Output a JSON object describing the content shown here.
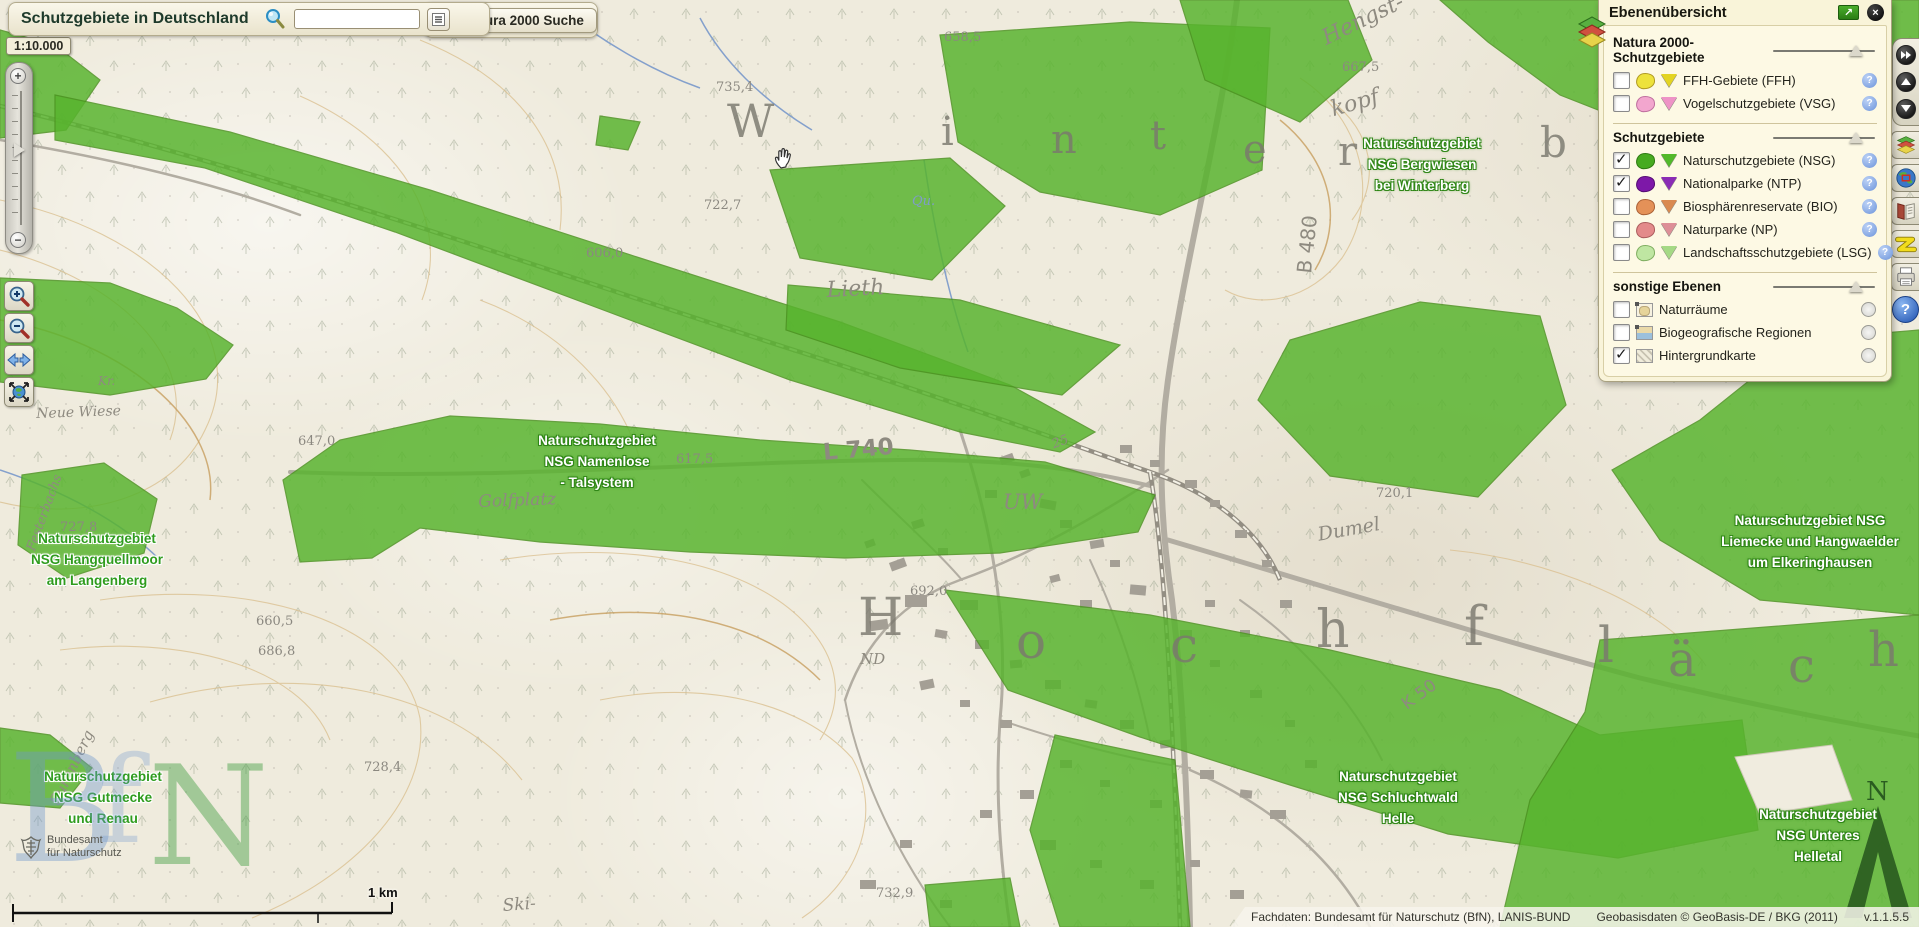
{
  "header": {
    "title": "Schutzgebiete in Deutschland",
    "search_value": "",
    "search_icon": "blue-magnifier",
    "results_icon": "list-lines",
    "natura_button": "Natura 2000 Suche",
    "natura_icon": "green-magnifier"
  },
  "scale_label": "1:10.000",
  "left_toolbar": {
    "icons": [
      "plus",
      "minus",
      "zoom-slider-thumb",
      "zoom-in-magnifier",
      "zoom-out-magnifier",
      "pan-arrows",
      "full-extent-globe"
    ]
  },
  "right_toolbar": {
    "icons": [
      "fast-forward",
      "arrow-up",
      "arrow-down",
      "layers-stack",
      "globe-overview",
      "legend-book",
      "measure-zigzag",
      "printer",
      "help"
    ],
    "help_glyph": "?"
  },
  "layer_panel": {
    "title": "Ebenenübersicht",
    "maximize_glyph": "↗",
    "close_glyph": "×",
    "sections": [
      {
        "title": "Natura 2000-Schutzgebiete",
        "items": [
          {
            "checked": false,
            "label": "FFH-Gebiete (FFH)",
            "color": "#ede23b",
            "border": "#b09a22",
            "tri": "#e3d422",
            "info": "question"
          },
          {
            "checked": false,
            "label": "Vogelschutzgebiete (VSG)",
            "color": "#f2a6ce",
            "border": "#bf6f9f",
            "tri": "#ee93c6",
            "info": "question"
          }
        ]
      },
      {
        "title": "Schutzgebiete",
        "items": [
          {
            "checked": true,
            "label": "Naturschutzgebiete (NSG)",
            "color": "#47ab21",
            "border": "#2e7a12",
            "tri": "#52b92a",
            "info": "question"
          },
          {
            "checked": true,
            "label": "Nationalparke (NTP)",
            "color": "#7d18a8",
            "border": "#550e74",
            "tri": "#8a2cb5",
            "info": "question"
          },
          {
            "checked": false,
            "label": "Biosphärenreservate (BIO)",
            "color": "#e49158",
            "border": "#aa6136",
            "tri": "#d98a50",
            "info": "question"
          },
          {
            "checked": false,
            "label": "Naturparke (NP)",
            "color": "#e38a8a",
            "border": "#ab5c5c",
            "tri": "#dd8f97",
            "info": "question"
          },
          {
            "checked": false,
            "label": "Landschaftsschutzgebiete (LSG)",
            "color": "#bfe6a2",
            "border": "#7fae60",
            "tri": "#a5d985",
            "info": "question"
          }
        ]
      },
      {
        "title": "sonstige Ebenen",
        "items": [
          {
            "checked": false,
            "label": "Naturräume",
            "icon": "naturraeume",
            "info": "radio"
          },
          {
            "checked": false,
            "label": "Biogeografische Regionen",
            "icon": "bioregionen",
            "info": "radio"
          },
          {
            "checked": true,
            "label": "Hintergrundkarte",
            "icon": "hatch",
            "info": "radio"
          }
        ]
      }
    ],
    "question_glyph": "?"
  },
  "footer": {
    "attribution": "Fachdaten: Bundesamt für Naturschutz (BfN), LANIS-BUND",
    "geodata": "Geobasisdaten © GeoBasis-DE / BKG (2011)",
    "version": "v.1.1.5.5"
  },
  "map": {
    "scalebar_label": "1 km",
    "north_label": "N",
    "bfn_logo": {
      "line1": "Bundesamt",
      "line2": "für Naturschutz"
    },
    "watermark": [
      {
        "t": "B",
        "x": 8,
        "y": 735,
        "s": 150,
        "c": "rgba(110,150,205,0.40)"
      },
      {
        "t": "f",
        "x": 98,
        "y": 742,
        "s": 120,
        "c": "rgba(110,150,205,0.30)"
      },
      {
        "t": "N",
        "x": 148,
        "y": 748,
        "s": 138,
        "c": "rgba(66,158,66,0.45)"
      }
    ],
    "area_labels_on_green": [
      {
        "x": 1422,
        "y": 133,
        "lines": [
          "Naturschutzgebiet",
          "NSG Bergwiesen",
          "bei Winterberg"
        ]
      },
      {
        "x": 597,
        "y": 430,
        "lines": [
          "Naturschutzgebiet",
          "NSG Namenlose",
          "- Talsystem"
        ]
      },
      {
        "x": 1810,
        "y": 510,
        "lines": [
          "Naturschutzgebiet NSG",
          "Liemecke und Hangwaelder",
          "um Elkeringhausen"
        ]
      },
      {
        "x": 1398,
        "y": 766,
        "lines": [
          "Naturschutzgebiet",
          "NSG Schluchtwald",
          "Helle"
        ]
      },
      {
        "x": 1818,
        "y": 804,
        "lines": [
          "Naturschutzgebiet",
          "NSG Unteres",
          "Helletal"
        ]
      }
    ],
    "area_labels_on_map": [
      {
        "x": 97,
        "y": 528,
        "lines": [
          "Naturschutzgebiet",
          "NSG Hangquellmoor",
          "am Langenberg"
        ]
      },
      {
        "x": 103,
        "y": 766,
        "lines": [
          "Naturschutzgebiet",
          "NSG Gutmecke",
          "und Renau"
        ]
      }
    ],
    "big_letters": [
      {
        "t": "W",
        "x": 727,
        "y": 98,
        "s": 46
      },
      {
        "t": "i",
        "x": 941,
        "y": 112,
        "s": 40
      },
      {
        "t": "n",
        "x": 1051,
        "y": 120,
        "s": 40
      },
      {
        "t": "t",
        "x": 1150,
        "y": 116,
        "s": 40
      },
      {
        "t": "e",
        "x": 1243,
        "y": 130,
        "s": 40
      },
      {
        "t": "r",
        "x": 1338,
        "y": 132,
        "s": 40
      },
      {
        "t": "b",
        "x": 1540,
        "y": 122,
        "s": 42
      },
      {
        "t": "H",
        "x": 858,
        "y": 592,
        "s": 52
      },
      {
        "t": "o",
        "x": 1016,
        "y": 616,
        "s": 50
      },
      {
        "t": "c",
        "x": 1170,
        "y": 620,
        "s": 50
      },
      {
        "t": "h",
        "x": 1316,
        "y": 604,
        "s": 52
      },
      {
        "t": "f",
        "x": 1464,
        "y": 600,
        "s": 54
      },
      {
        "t": "l",
        "x": 1598,
        "y": 620,
        "s": 50
      },
      {
        "t": "ä",
        "x": 1668,
        "y": 636,
        "s": 48
      },
      {
        "t": "c",
        "x": 1788,
        "y": 642,
        "s": 48
      },
      {
        "t": "h",
        "x": 1868,
        "y": 626,
        "s": 48
      }
    ],
    "place_labels": [
      {
        "t": "Lieth",
        "x": 826,
        "y": 278,
        "s": 22,
        "r": -3
      },
      {
        "t": "Golfplatz",
        "x": 478,
        "y": 492,
        "s": 17,
        "r": -2
      },
      {
        "t": "Dumel",
        "x": 1316,
        "y": 524,
        "s": 19,
        "r": -10
      },
      {
        "t": "Neue Wiese",
        "x": 36,
        "y": 406,
        "s": 14,
        "r": -2
      },
      {
        "t": "Surenberg",
        "x": 46,
        "y": 800,
        "s": 15,
        "r": -64
      },
      {
        "t": "Festerbachs",
        "x": 24,
        "y": 548,
        "s": 13,
        "r": -70
      },
      {
        "t": "Hengst-",
        "x": 1318,
        "y": 28,
        "s": 22,
        "r": -26
      },
      {
        "t": "kopf",
        "x": 1328,
        "y": 98,
        "s": 22,
        "r": -16
      },
      {
        "t": "B 480",
        "x": 1292,
        "y": 272,
        "s": 20,
        "r": -84,
        "f": "sans"
      },
      {
        "t": "L 740",
        "x": 822,
        "y": 440,
        "s": 23,
        "r": -5,
        "f": "sans",
        "b": 1
      },
      {
        "t": "K 50",
        "x": 1398,
        "y": 698,
        "s": 17,
        "r": -36,
        "f": "sans"
      },
      {
        "t": "UW",
        "x": 1003,
        "y": 490,
        "s": 21,
        "r": 0
      },
      {
        "t": "ND",
        "x": 860,
        "y": 650,
        "s": 15,
        "r": 0
      },
      {
        "t": "25",
        "x": 1050,
        "y": 438,
        "s": 13,
        "r": -20
      },
      {
        "t": "Qu.",
        "x": 912,
        "y": 194,
        "s": 13,
        "r": 0,
        "c": "#7f9cc9"
      },
      {
        "t": "Ski-",
        "x": 502,
        "y": 896,
        "s": 17,
        "r": -4
      },
      {
        "t": "Kr.",
        "x": 98,
        "y": 374,
        "s": 12,
        "r": 0
      }
    ],
    "elevations": [
      {
        "t": "658,5",
        "x": 944,
        "y": 30
      },
      {
        "t": "735,4",
        "x": 716,
        "y": 80
      },
      {
        "t": "667,5",
        "x": 1342,
        "y": 60
      },
      {
        "t": "722,7",
        "x": 704,
        "y": 198
      },
      {
        "t": "606,0",
        "x": 586,
        "y": 246
      },
      {
        "t": "647,0",
        "x": 298,
        "y": 434
      },
      {
        "t": "617,5",
        "x": 676,
        "y": 452
      },
      {
        "t": "660,5",
        "x": 256,
        "y": 614
      },
      {
        "t": "686,8",
        "x": 258,
        "y": 644
      },
      {
        "t": "727,8",
        "x": 60,
        "y": 520
      },
      {
        "t": "692,0",
        "x": 910,
        "y": 584
      },
      {
        "t": "728,4",
        "x": 364,
        "y": 760
      },
      {
        "t": "732,9",
        "x": 876,
        "y": 886
      },
      {
        "t": "720,1",
        "x": 1376,
        "y": 486
      }
    ],
    "green_style": {
      "fill": "#58b42e",
      "stroke": "#4b9220",
      "opacity": 0.84
    },
    "green_areas": [
      "0,30 55,45 100,80 66,130 0,138",
      "55,95 230,132 430,190 640,258 840,322 1010,385 1095,432 1060,452 960,432 790,380 590,305 395,232 205,168 55,140",
      "283,480 340,440 450,416 600,424 760,440 910,450 1045,462 1155,495 1138,532 1000,553 845,558 690,552 540,542 420,528 372,558 300,562",
      "0,278 110,283 177,308 233,345 206,379 110,395 0,382",
      "22,475 104,463 157,499 144,553 67,578 18,545",
      "0,728 50,735 92,768 60,808 0,803",
      "600,116 640,122 628,150 596,145",
      "770,170 950,158 1005,206 932,280 800,258",
      "940,35 1130,22 1270,28 1262,170 1160,215 1040,192 958,142",
      "788,285 960,300 1120,345 1062,395 900,368 786,330",
      "1180,0 1348,0 1372,60 1300,122 1205,80",
      "1440,0 1919,0 1919,38 1820,90 1700,150 1560,95 1488,42",
      "1628,62 1850,92 1812,135 1655,108",
      "1258,400 1290,340 1420,302 1540,316 1566,405 1478,497 1330,476",
      "1612,470 1700,420 1800,340 1919,330 1919,615 1760,600 1660,540",
      "945,590 1150,615 1330,650 1500,690 1600,735 1742,720 1758,830 1618,858 1448,834 1290,785 1140,737 1008,690",
      "1030,830 1055,735 1175,760 1190,927 1060,927",
      "1530,800 1585,712 1600,640 1919,615 1919,927 1500,927",
      "925,885 1010,878 1020,927 930,927"
    ],
    "green_holes": [
      "1735,757 1832,745 1852,800 1760,815"
    ],
    "roads": [
      {
        "d": "M 1237,0 C 1222,120 1185,260 1168,380 C 1158,450 1160,520 1172,600 C 1184,700 1188,820 1190,927",
        "w": 6
      },
      {
        "d": "M 1168,540 C 1320,585 1480,635 1640,678 C 1740,702 1840,722 1919,736",
        "w": 5
      },
      {
        "d": "M 290,472 C 500,480 700,462 900,460 C 1000,459 1080,468 1150,486",
        "w": 4
      },
      {
        "d": "M 960,430 C 990,520 1010,620 1000,720 C 995,790 1000,860 1010,927",
        "w": 3
      },
      {
        "d": "M 1168,470 C 1100,515 1030,555 960,580 C 905,600 865,640 845,700",
        "w": 2.5
      },
      {
        "d": "M 1000,720 C 1060,740 1120,758 1190,768",
        "w": 2
      },
      {
        "d": "M 1090,560 C 1118,620 1138,680 1150,740",
        "w": 2
      },
      {
        "d": "M 862,480 C 902,520 938,552 962,580",
        "w": 2
      },
      {
        "d": "M 1240,600 C 1300,642 1352,700 1382,760",
        "w": 2
      },
      {
        "d": "M 1190,770 C 1260,800 1330,850 1370,927",
        "w": 2.5
      },
      {
        "d": "M 0,140 C 120,160 220,185 300,215",
        "w": 2.5
      },
      {
        "d": "M 845,700 C 860,780 900,860 950,927",
        "w": 2
      }
    ],
    "railways": [
      {
        "d": "M 0,106 C 260,168 520,262 800,352 C 950,400 1065,442 1150,472 C 1210,492 1260,530 1280,580"
      },
      {
        "d": "M 1150,472 C 1165,560 1172,700 1180,927"
      }
    ],
    "streams": [
      {
        "d": "M 924,160 C 934,228 948,295 968,352"
      },
      {
        "d": "M 700,18 C 722,60 762,100 812,130"
      },
      {
        "d": "M 560,8 C 600,40 650,70 700,88"
      },
      {
        "d": "M 0,470 C 60,490 120,520 160,560"
      }
    ],
    "contours": [
      "M 0,200 C 150,230 255,330 205,430 C 172,500 80,522 0,502",
      "M 0,250 C 120,280 200,360 170,440",
      "M 100,600 C 250,578 400,620 420,718 C 430,800 352,878 252,918",
      "M 60,650 C 180,635 300,665 330,740",
      "M 500,560 C 620,540 742,560 802,620 C 840,658 845,700 820,740",
      "M 600,700 C 700,680 800,700 852,758 C 882,810 862,878 802,918",
      "M 1300,78 C 1362,118 1382,198 1342,258 C 1310,300 1260,310 1225,290",
      "M 1330,100 C 1372,130 1382,180 1352,220",
      "M 1450,550 C 1550,560 1650,600 1702,660",
      "M 300,96 C 400,140 452,220 422,300",
      "M 420,40 C 520,80 570,150 560,230",
      "M 150,702 C 300,660 452,690 522,780",
      "M 1700,250 C 1780,270 1850,310 1890,360",
      "M 480,300 C 560,330 620,390 640,460"
    ],
    "index_contours": [
      "M 0,320 C 120,340 220,420 210,500",
      "M 550,620 C 660,600 760,620 820,680",
      "M 1280,120 C 1330,160 1345,220 1315,270"
    ],
    "buildings": [
      [
        1000,
        455,
        14,
        8,
        -20
      ],
      [
        1020,
        470,
        10,
        7,
        -20
      ],
      [
        985,
        490,
        12,
        8,
        0
      ],
      [
        1040,
        500,
        16,
        9,
        10
      ],
      [
        1060,
        520,
        12,
        8,
        0
      ],
      [
        1090,
        540,
        14,
        8,
        -10
      ],
      [
        1110,
        560,
        10,
        7,
        0
      ],
      [
        1130,
        585,
        16,
        10,
        5
      ],
      [
        1080,
        600,
        12,
        8,
        0
      ],
      [
        1050,
        575,
        10,
        7,
        -15
      ],
      [
        960,
        600,
        18,
        10,
        0
      ],
      [
        935,
        630,
        12,
        8,
        10
      ],
      [
        975,
        640,
        14,
        9,
        0
      ],
      [
        1010,
        660,
        12,
        8,
        -5
      ],
      [
        1045,
        680,
        16,
        9,
        0
      ],
      [
        1085,
        700,
        12,
        8,
        8
      ],
      [
        1120,
        720,
        14,
        9,
        0
      ],
      [
        1160,
        740,
        12,
        8,
        -6
      ],
      [
        1000,
        720,
        12,
        8,
        0
      ],
      [
        960,
        700,
        10,
        7,
        0
      ],
      [
        920,
        680,
        14,
        9,
        -12
      ],
      [
        890,
        560,
        16,
        9,
        -20
      ],
      [
        865,
        540,
        10,
        7,
        -20
      ],
      [
        912,
        520,
        12,
        8,
        -18
      ],
      [
        938,
        548,
        10,
        7,
        0
      ],
      [
        1200,
        770,
        14,
        9,
        0
      ],
      [
        1240,
        790,
        12,
        8,
        6
      ],
      [
        1270,
        810,
        16,
        9,
        0
      ],
      [
        1150,
        800,
        12,
        8,
        0
      ],
      [
        1100,
        780,
        10,
        7,
        0
      ],
      [
        1060,
        760,
        12,
        8,
        0
      ],
      [
        1020,
        790,
        14,
        9,
        0
      ],
      [
        980,
        810,
        12,
        8,
        0
      ],
      [
        1040,
        840,
        16,
        10,
        0
      ],
      [
        1090,
        860,
        12,
        8,
        0
      ],
      [
        1140,
        880,
        14,
        9,
        0
      ],
      [
        900,
        840,
        12,
        8,
        0
      ],
      [
        860,
        880,
        16,
        9,
        0
      ],
      [
        940,
        900,
        12,
        8,
        0
      ],
      [
        1190,
        860,
        10,
        7,
        0
      ],
      [
        1230,
        890,
        14,
        9,
        0
      ],
      [
        1262,
        560,
        10,
        7,
        0
      ],
      [
        1280,
        600,
        12,
        8,
        0
      ],
      [
        1240,
        630,
        10,
        7,
        0
      ],
      [
        1205,
        600,
        10,
        7,
        0
      ],
      [
        1180,
        630,
        12,
        8,
        0
      ],
      [
        1210,
        660,
        10,
        7,
        0
      ],
      [
        1250,
        690,
        12,
        8,
        0
      ],
      [
        1285,
        720,
        10,
        7,
        0
      ],
      [
        1305,
        760,
        12,
        8,
        0
      ],
      [
        905,
        595,
        22,
        12,
        0
      ],
      [
        870,
        620,
        18,
        10,
        -8
      ],
      [
        1120,
        445,
        12,
        8,
        0
      ],
      [
        1150,
        460,
        10,
        7,
        0
      ],
      [
        1185,
        480,
        12,
        8,
        0
      ],
      [
        1210,
        500,
        10,
        7,
        0
      ],
      [
        1235,
        530,
        12,
        8,
        0
      ]
    ],
    "scalebar": {
      "x1": 13,
      "x2": 392,
      "y": 913,
      "mid_tick": 318
    }
  }
}
